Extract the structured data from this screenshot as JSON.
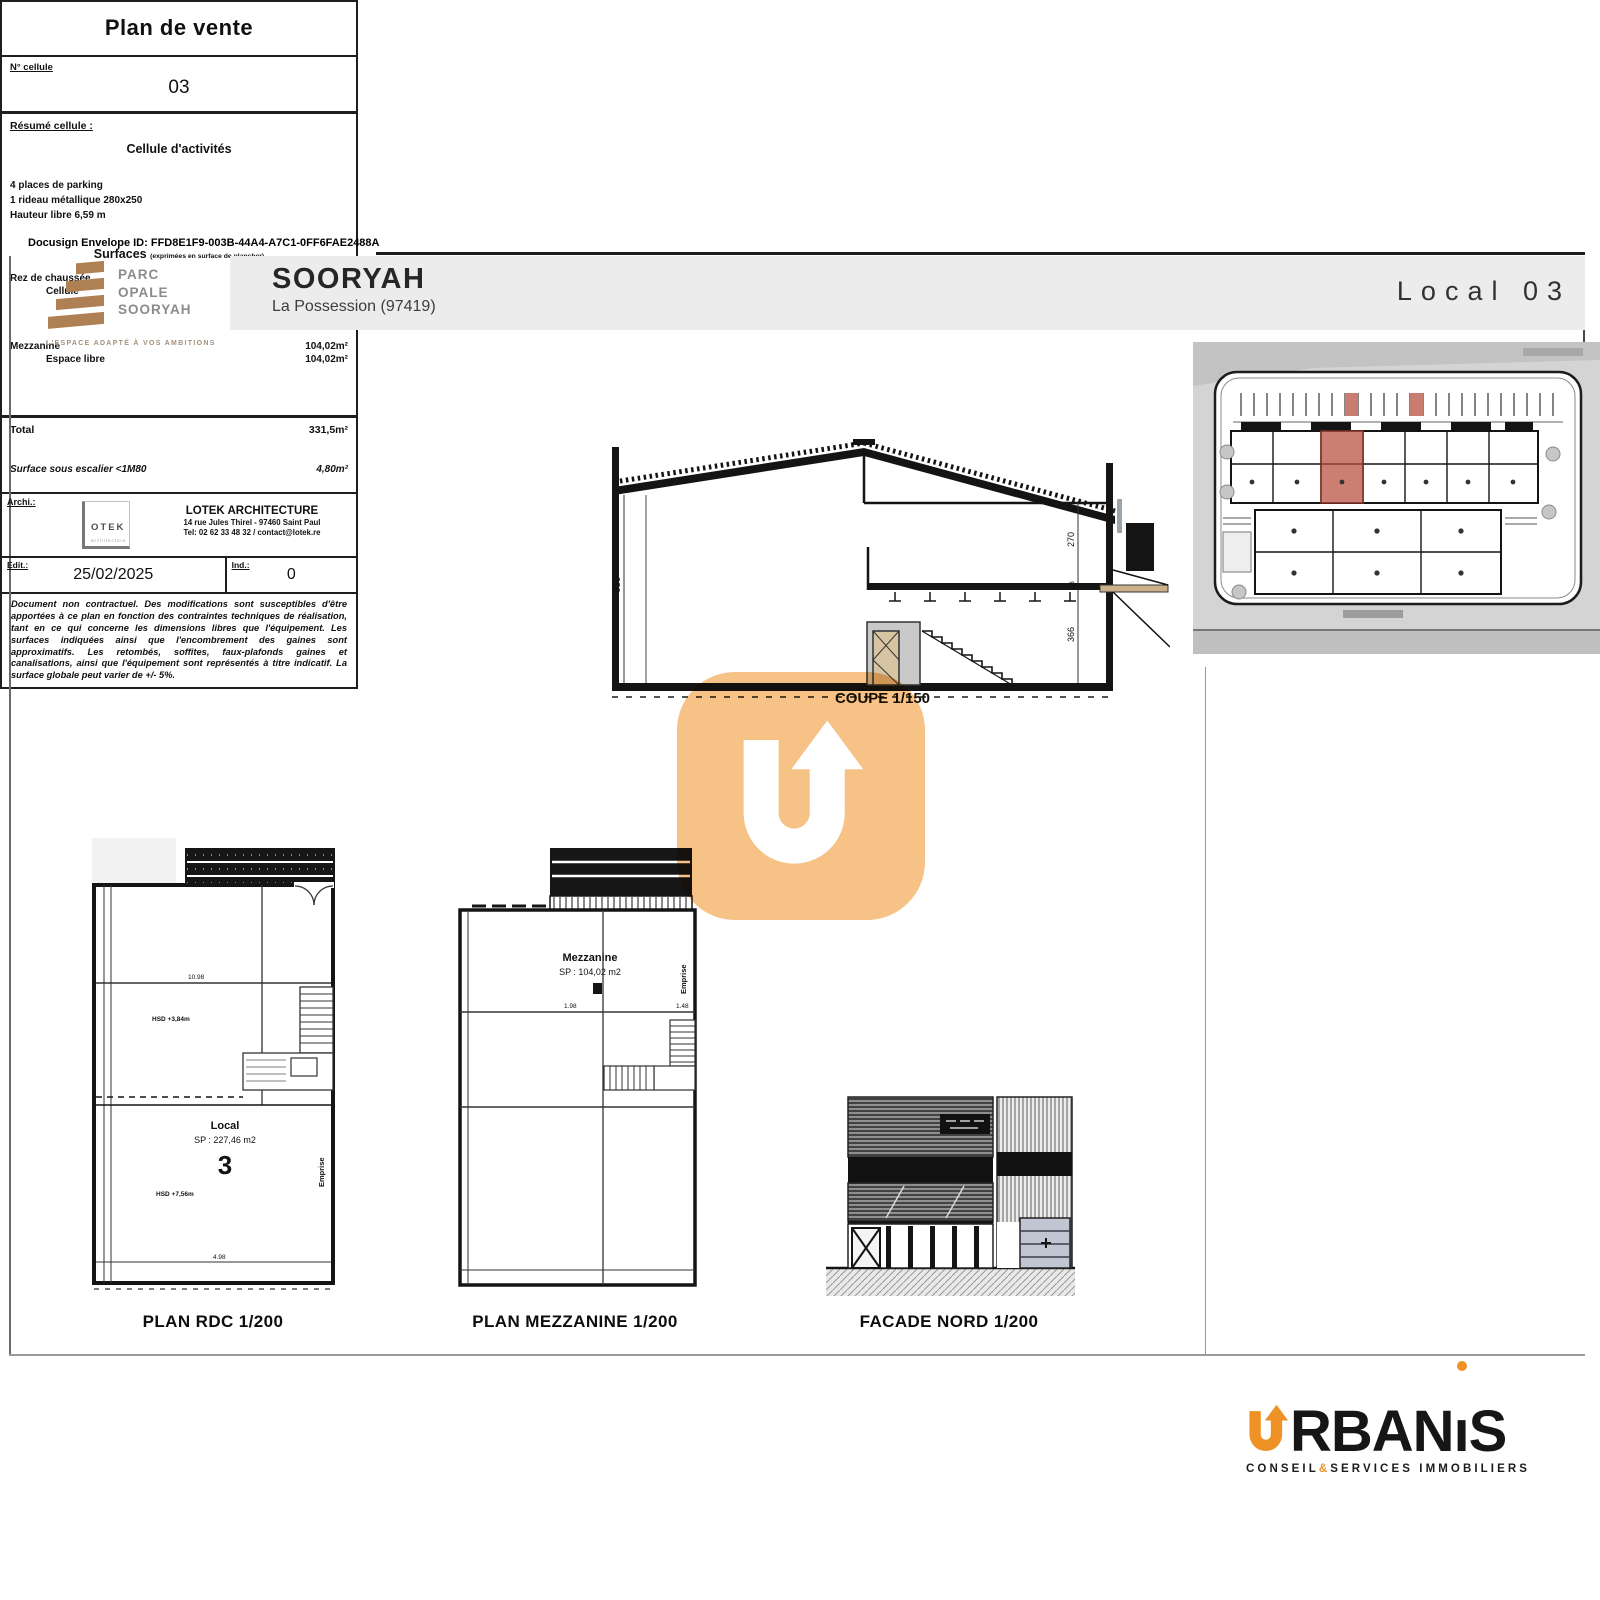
{
  "docusign": "Docusign Envelope ID: FFD8E1F9-003B-44A4-A7C1-0FF6FAE2488A",
  "header": {
    "project": "SOORYAH",
    "location": "La Possession (97419)",
    "unit": "Local 03",
    "logo": {
      "line1": "PARC",
      "line2": "OPALE",
      "line3": "SOORYAH",
      "tagline": "L'ESPACE ADAPTÉ À VOS AMBITIONS"
    }
  },
  "drawings": {
    "coupe": {
      "label": "COUPE 1/150",
      "dim_left": "659",
      "dim_right_top": "270",
      "dim_right_mid": "23",
      "dim_right_bottom": "366"
    },
    "rdc": {
      "caption": "PLAN RDC 1/200",
      "room_label": "Local",
      "room_area": "SP : 227,46 m2",
      "room_number": "3",
      "note_upper": "HSD +3,84m",
      "note_lower": "HSD +7,56m",
      "emprise": "Emprise",
      "dim_top": "10.98",
      "dim_bottom": "4.98"
    },
    "mezzanine": {
      "caption": "PLAN MEZZANINE 1/200",
      "room_label": "Mezzanine",
      "room_area": "SP : 104,02 m2",
      "emprise": "Emprise",
      "dim_left": "1.98",
      "dim_right": "1.48"
    },
    "facade": {
      "caption": "FACADE NORD 1/200"
    }
  },
  "panel": {
    "title": "Plan de vente",
    "cell_label": "N° cellule",
    "cell_value": "03",
    "resume_label": "Résumé cellule :",
    "resume_title": "Cellule d'activités",
    "resume_line1": "4 places de parking",
    "resume_line2": "1 rideau métallique 280x250",
    "resume_line3": "Hauteur libre 6,59 m",
    "surfaces_title": "Surfaces",
    "surfaces_note": "(exprimées en surface de plancher)",
    "surface_rows": [
      {
        "label": "Rez de chaussée",
        "value": "227,46m²"
      },
      {
        "label": "Cellule",
        "value": "227,46m²"
      },
      {
        "label": "Mezzanine",
        "value": "104,02m²"
      },
      {
        "label": "Espace libre",
        "value": "104,02m²"
      }
    ],
    "total_label": "Total",
    "total_value": "331,5m²",
    "stairs_label": "Surface sous escalier <1M80",
    "stairs_value": "4,80m²",
    "architect_label": "Archi.:",
    "lotek_logo_text": "OTEK",
    "lotek_logo_sub": "architecture",
    "architect_name": "LOTEK ARCHITECTURE",
    "architect_address": "14 rue Jules Thirel - 97460 Saint Paul",
    "architect_contact": "Tel: 02 62 33 48 32 / contact@lotek.re",
    "date_label": "Edit.:",
    "date_value": "25/02/2025",
    "ind_label": "Ind.:",
    "ind_value": "0",
    "disclaimer": "Document non contractuel. Des modifications sont susceptibles d'être apportées à ce plan en fonction des contraintes techniques de réalisation, tant en ce qui concerne les dimensions libres que l'équipement. Les surfaces indiquées ainsi que l'encombrement des gaines sont approximatifs. Les retombés, soffites, faux-plafonds gaines et canalisations, ainsi que l'équipement sont représentés à titre indicatif. La surface globale peut varier de +/- 5%."
  },
  "footer": {
    "name_part1": "RBAN",
    "name_i": "ı",
    "name_part2": "S",
    "tagline_left": "CONSEIL",
    "tagline_amp": "&",
    "tagline_right": "SERVICES IMMOBILIERS"
  },
  "colors": {
    "accent_orange": "#ef9226",
    "watermark_orange": "#f6c286",
    "highlight_salmon": "#cb7f72",
    "logo_brown": "#ae8054",
    "band_gray": "#ececec"
  }
}
